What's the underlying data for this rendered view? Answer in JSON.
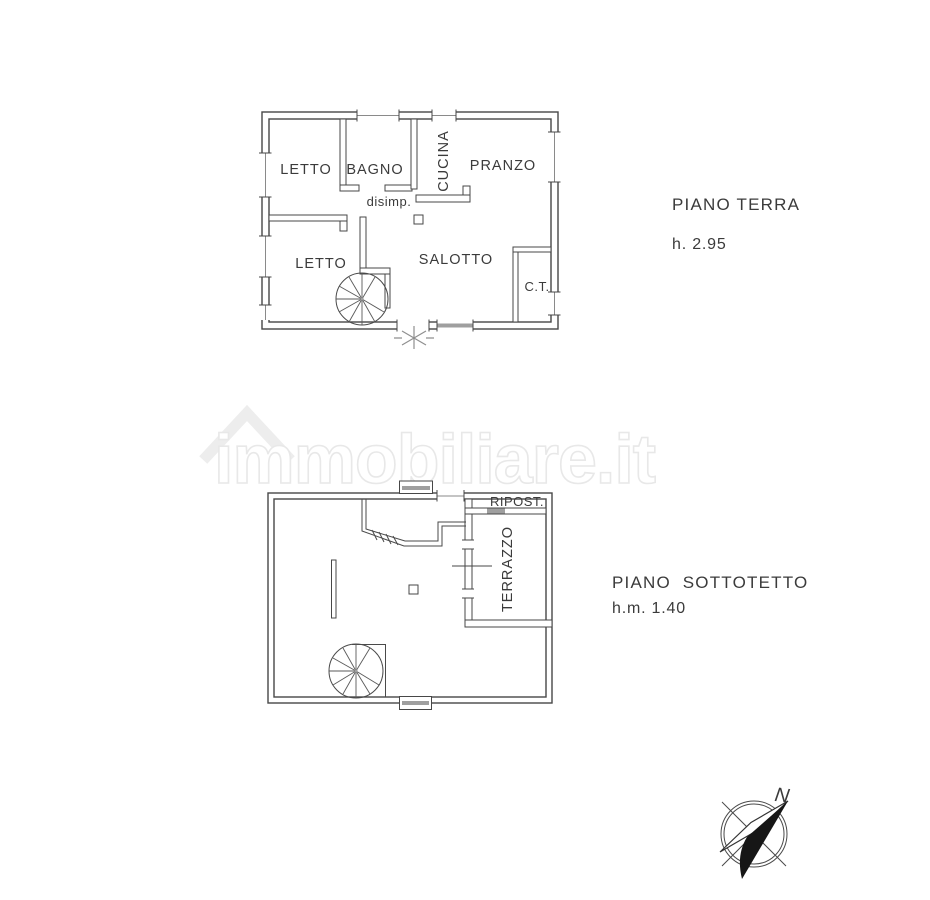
{
  "colors": {
    "background": "#ffffff",
    "line": "#474747",
    "text": "#3b3b3b",
    "watermark_outline": "#e8e8e8"
  },
  "watermark": {
    "text": "immobiliare.it",
    "logo": "house-roof-icon"
  },
  "ground_floor": {
    "title": "PIANO TERRA",
    "height_label": "h. 2.95",
    "rooms": {
      "letto_top": "LETTO",
      "bagno": "BAGNO",
      "cucina": "CUCINA",
      "pranzo": "PRANZO",
      "disimpegno": "disimp.",
      "letto_bottom": "LETTO",
      "salotto": "SALOTTO",
      "centrale_termica": "C.T."
    }
  },
  "attic_floor": {
    "title": "PIANO  SOTTOTETTO",
    "height_label": "h.m. 1.40",
    "rooms": {
      "ripostiglio": "RIPOST.",
      "terrazzo": "TERRAZZO"
    }
  },
  "compass": {
    "north_label": "N"
  }
}
